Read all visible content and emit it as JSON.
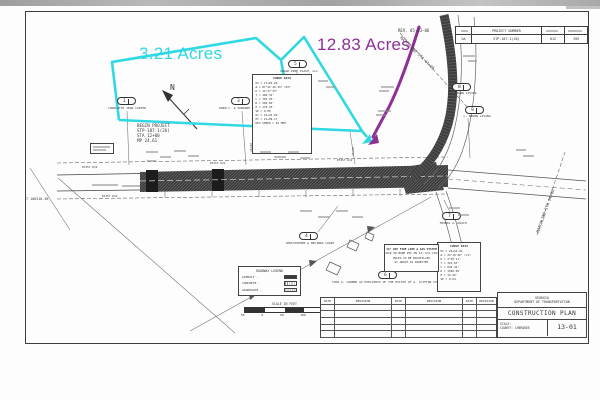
{
  "header": {
    "rev_label": "REV. 05-03-06",
    "project_number_label": "PROJECT NUMBER",
    "state": "GA",
    "project_number": "STP-187-1(26)",
    "sheet_no": "012",
    "total_sheets": "195"
  },
  "annotations": {
    "area_left": "3.21 Acres",
    "area_right": "12.83 Acres",
    "cyan_color": "#2fd8e2",
    "purple_color": "#8e3095"
  },
  "plan": {
    "north_label": "N",
    "begin_project": [
      "BEGIN PROJECT",
      "STP-187-1(26)",
      "STA 12+00",
      "MP 24.61"
    ],
    "matchline_top": "MATCHLINE STA 44+00",
    "matchline_right": "MATCHLINE STA 24+00",
    "stations": {
      "s15": "15+00",
      "s20": "20+00"
    },
    "exist_rw": "EXIST R/W",
    "coord": "7 100318.38",
    "parcels": [
      {
        "id": "1",
        "name": "CHARLOTTE JEAN CARTER"
      },
      {
        "id": "3",
        "name": "DREW C. & SUNDINE HOLLEY"
      },
      {
        "id": "5",
        "name": "SUGAR PINE PLACE, LLC"
      },
      {
        "id": "8",
        "name": "L. BROWN LIVING"
      },
      {
        "id": "9",
        "name": "L. BROWN LIVING"
      },
      {
        "id": "4",
        "name": "CHRISTOPHER & MELINDA COURT"
      },
      {
        "id": "6",
        "name": "TONI A. CONNER AS EXECUTRIX OF THE ESTATE OF A. CLIFTON CONNER"
      },
      {
        "id": "7",
        "name": "THOMAS A. ROACH"
      }
    ],
    "curve_data_1": {
      "title": "CURVE DATA",
      "lines": [
        "PI = 17+04.26",
        "Δ = 87°41'26.36\" (RT)",
        "D = 11°27'33\"",
        "T = 480.34'",
        "L = 765.25'",
        "R = 500.00'",
        "E = 170.35'",
        "SE = 0.06",
        "PC = 14+23.92",
        "PT = 21+89.17",
        "DES SPEED = 45 MPH"
      ]
    },
    "curve_data_2": {
      "title": "CURVE DATA",
      "lines": [
        "PI = 26+10.44",
        "Δ = 24°18'40\" (LT)",
        "D = 3°49'11\"",
        "T = 322.93'",
        "L = 636.42'",
        "R = 1500.00'",
        "E = 34.26'",
        "SE = 0.04"
      ]
    },
    "note_box": {
      "lines": [
        "16\" DIP FIRE LINE & GAS SYSTEM",
        "JACK OR BORE PVC ON 24\" STL CASING",
        "HOLES TO BE BACKFILLED",
        "W/ GROUT AS DIRECTED"
      ]
    }
  },
  "legend": {
    "title": "ROADWAY LEGEND",
    "items": [
      "ASPHALT -",
      "CONCRETE -",
      "AGGREGATE -"
    ]
  },
  "scale_bar": {
    "title": "SCALE IN FEET",
    "ticks": [
      "50",
      "0",
      "50",
      "100",
      "150"
    ]
  },
  "revision_table": {
    "headers": [
      "DATE",
      "REVISION",
      "DATE",
      "REVISION",
      "DATE",
      "REVISION"
    ]
  },
  "title_block": {
    "agency_line1": "GEORGIA",
    "agency_line2": "DEPARTMENT OF TRANSPORTATION",
    "plan_title": "CONSTRUCTION PLAN",
    "scale_label": "SCALE:",
    "county_label": "COUNTY: CHEROKEE",
    "sheet_number": "13-01"
  }
}
